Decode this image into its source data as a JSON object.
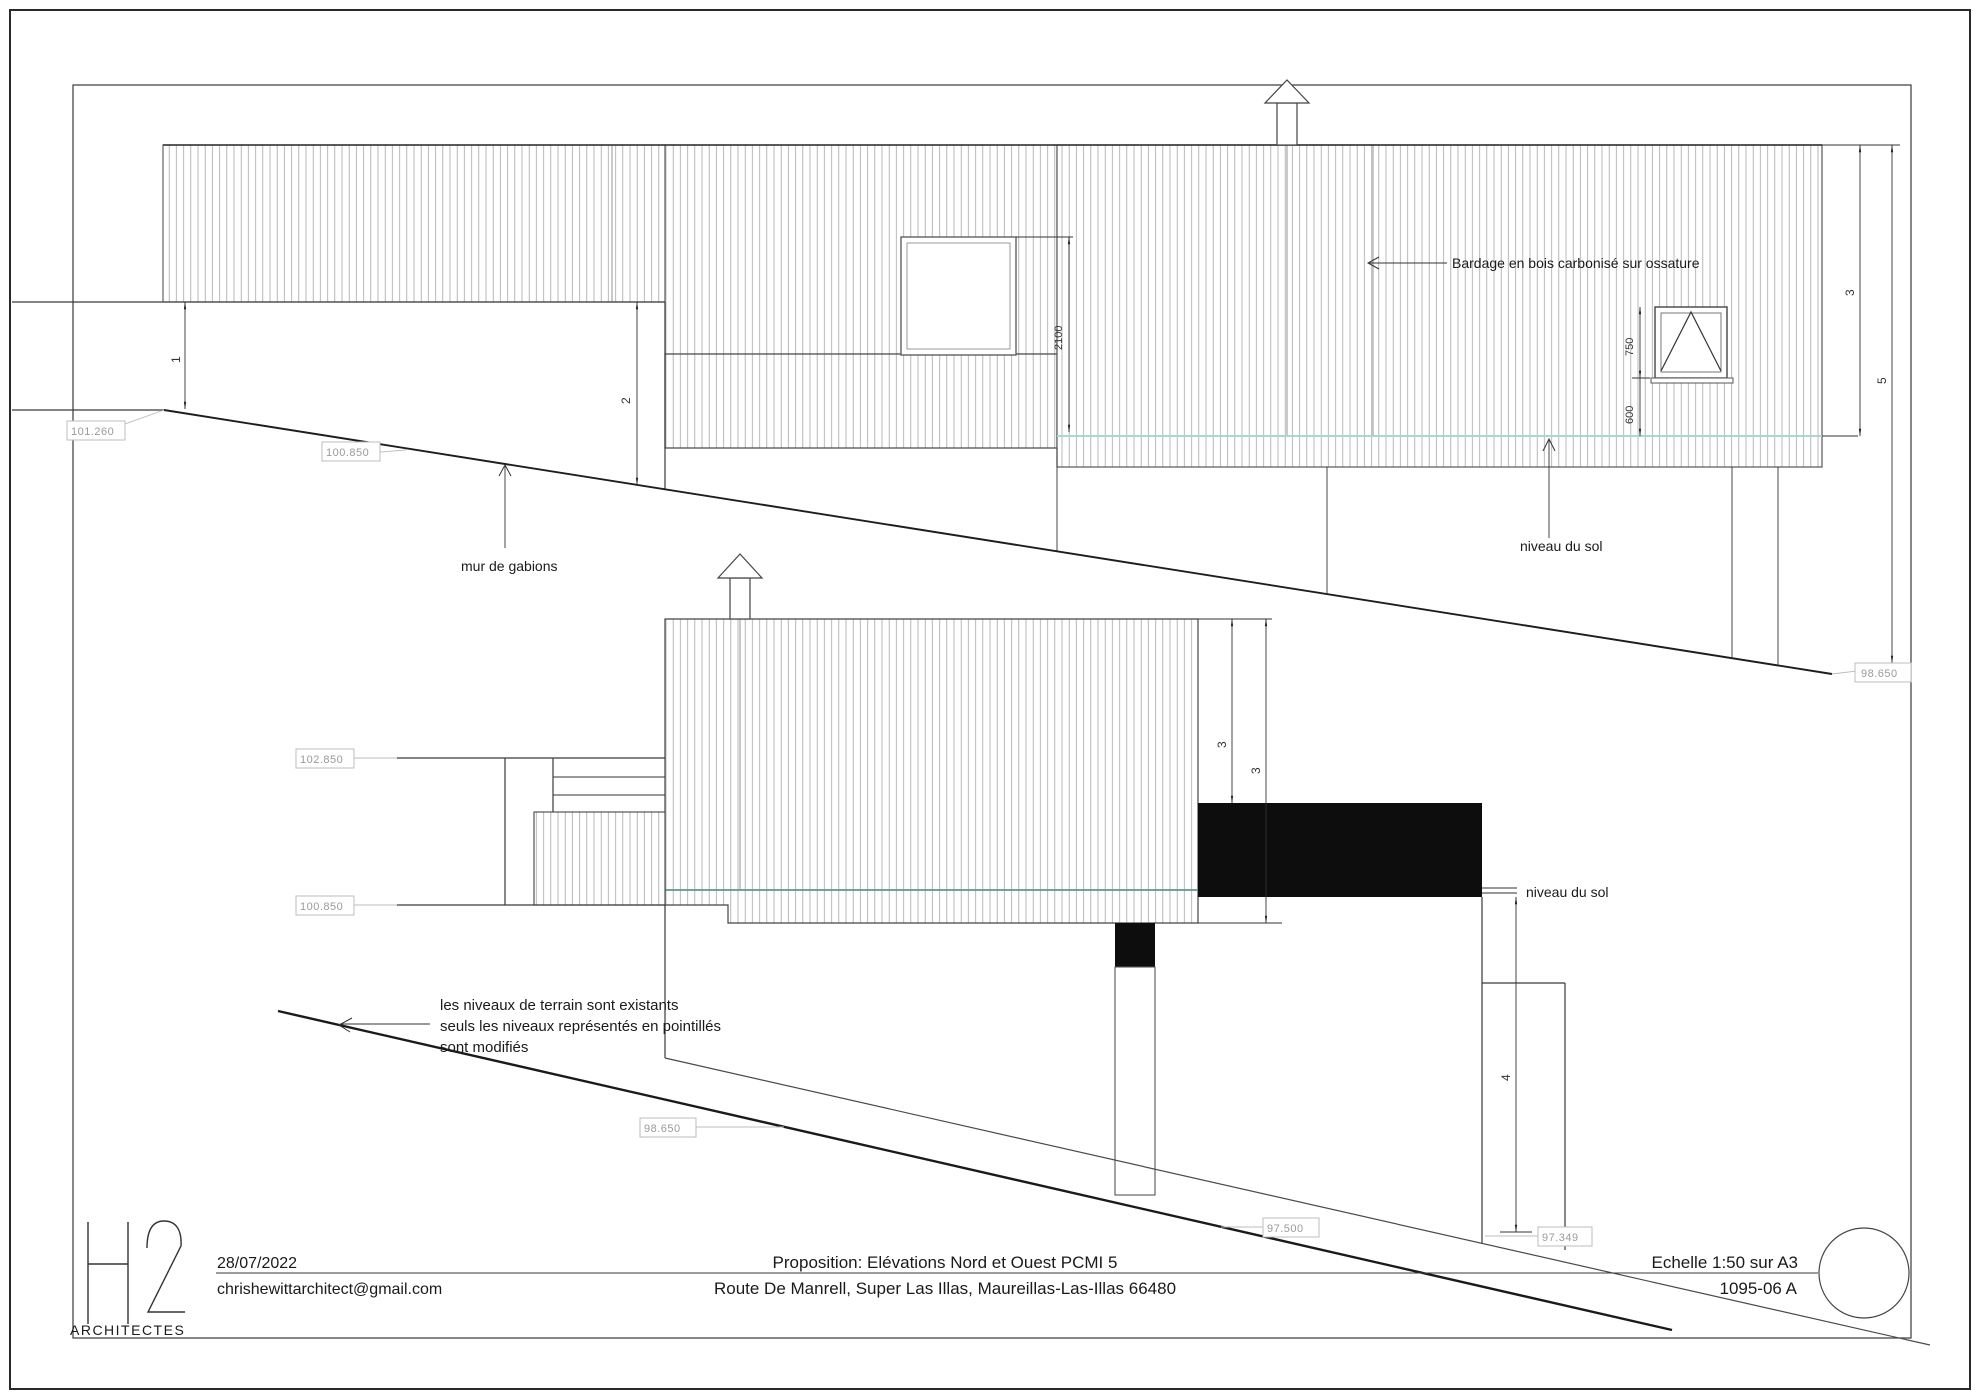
{
  "title_block": {
    "date": "28/07/2022",
    "email": "chrishewittarchitect@gmail.com",
    "title_line1": "Proposition: Elévations Nord et Ouest PCMI 5",
    "title_line2": "Route De Manrell, Super Las Illas, Maureillas-Las-Illas 66480",
    "scale": "Echelle 1:50 sur A3",
    "drawing_number": "1095-06 A",
    "logo_h": "H",
    "logo_2": "2",
    "logo_sub": "ARCHITECTES"
  },
  "annotations": {
    "bardage": "Bardage en bois carbonisé sur ossature",
    "niveau_du_sol_top": "niveau du sol",
    "niveau_du_sol_bottom": "niveau du sol",
    "mur_de_gabions": "mur de gabions",
    "terrain_note_line1": "les niveaux de terrain sont existants",
    "terrain_note_line2": "seuls les niveaux représentés en pointillés",
    "terrain_note_line3": "sont modifiés"
  },
  "levels": {
    "top_101_260": "101.260",
    "top_100_850": "100.850",
    "top_98_650": "98.650",
    "bot_102_850": "102.850",
    "bot_100_850": "100.850",
    "bot_98_650": "98.650",
    "bot_97_500": "97.500",
    "bot_97_349": "97.349"
  },
  "dimensions": {
    "door_height": "2100",
    "window_height": "750",
    "window_sill": "600",
    "key_1": "1",
    "key_2": "2",
    "key_3_top": "3",
    "key_5_top": "5",
    "key_3a_bottom": "3",
    "key_3b_bottom": "3",
    "key_4_bottom": "4"
  },
  "colors": {
    "ground_line_top": "#a8d8d0",
    "ground_line_bottom": "#5d978c",
    "hatch": "#a6a6a6",
    "balcony_fill": "#0d0d0d"
  }
}
